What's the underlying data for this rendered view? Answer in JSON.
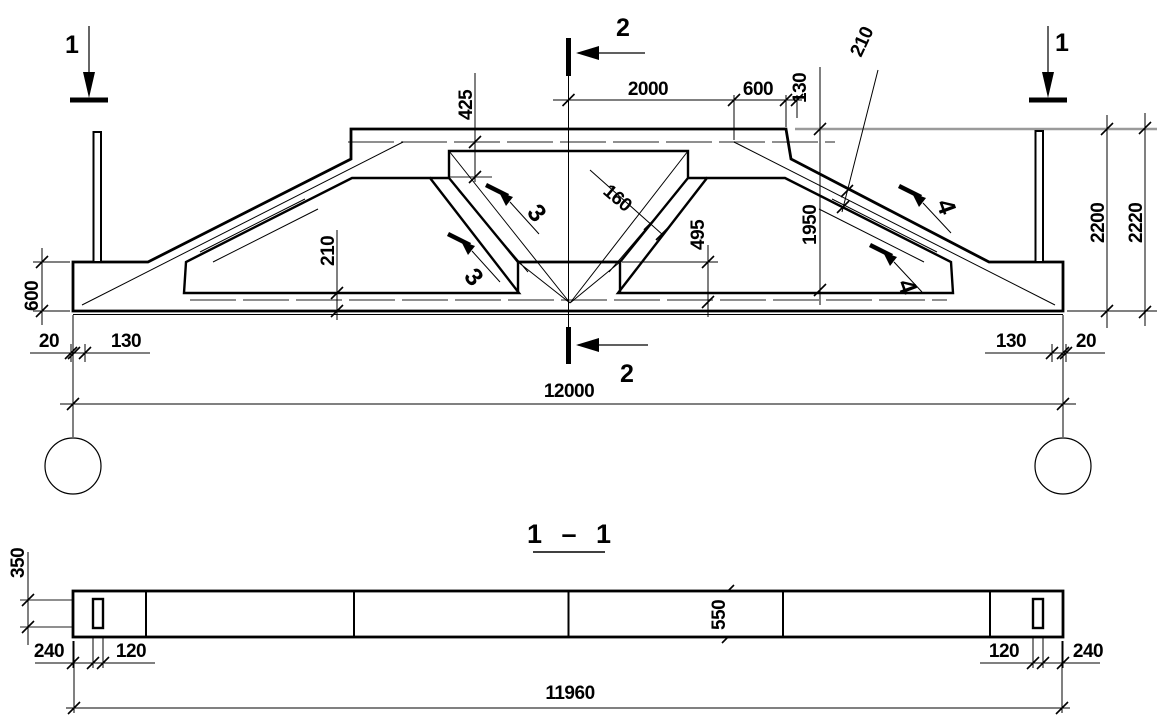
{
  "drawing": {
    "colors": {
      "line": "#000000",
      "axis_gray": "#8f8f8f",
      "background": "#ffffff"
    },
    "elevation": {
      "markers": {
        "cut1": "1",
        "cut2": "2",
        "cut3": "3",
        "cut4": "4"
      },
      "dims": {
        "top_half_span": "2000",
        "top_end_panel": "600",
        "top_edge_offset": "130",
        "chord_axis_offset": "425",
        "inner_height": "1950",
        "diagonal_thickness": "160",
        "node_height": "495",
        "slope_chord_thickness": "210",
        "height_total": "2200",
        "height_overall": "2220",
        "bearing_height": "600",
        "bottom_chord_thickness": "210",
        "bottom_left_offset": "20",
        "bottom_left_inset": "130",
        "bottom_right_inset": "130",
        "bottom_right_offset": "20",
        "span": "12000"
      }
    },
    "section": {
      "title": "1 – 1",
      "dims": {
        "flange_width": "350",
        "depth": "550",
        "end_offset_left": "240",
        "loop_width_left": "120",
        "loop_width_right": "120",
        "end_offset_right": "240",
        "length": "11960"
      }
    }
  }
}
